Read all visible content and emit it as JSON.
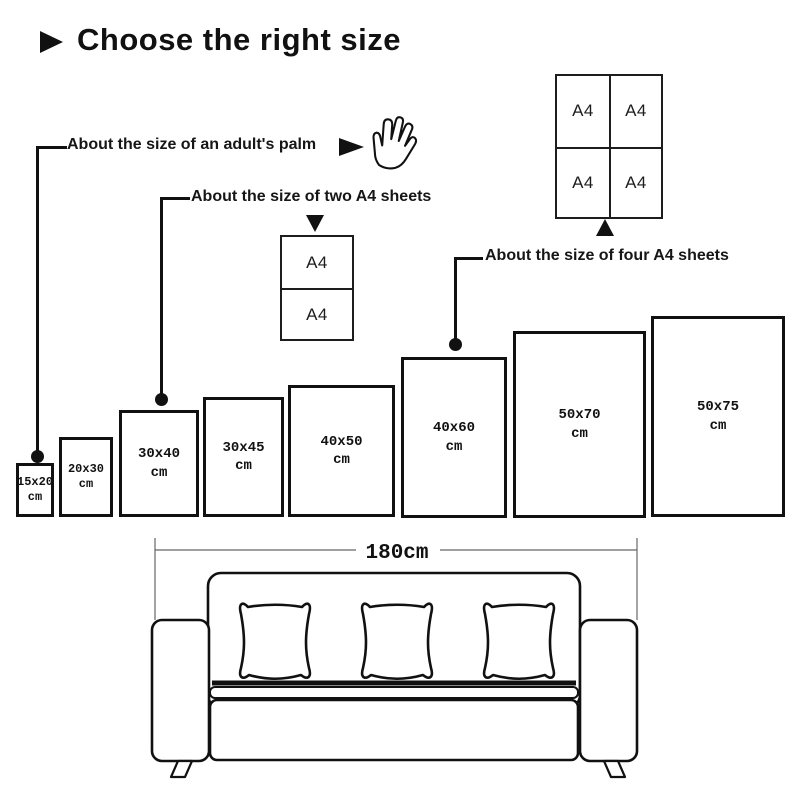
{
  "title": {
    "text": "Choose the right size"
  },
  "annotations": {
    "palm": "About the size of an adult's palm",
    "two_a4": "About the size of two A4 sheets",
    "four_a4": "About the size of four A4 sheets"
  },
  "a4_label": "A4",
  "frames": [
    {
      "size": "15x20",
      "unit": "cm"
    },
    {
      "size": "20x30",
      "unit": "cm"
    },
    {
      "size": "30x40",
      "unit": "cm"
    },
    {
      "size": "30x45",
      "unit": "cm"
    },
    {
      "size": "40x50",
      "unit": "cm"
    },
    {
      "size": "40x60",
      "unit": "cm"
    },
    {
      "size": "50x70",
      "unit": "cm"
    },
    {
      "size": "50x75",
      "unit": "cm"
    }
  ],
  "sofa": {
    "width_label": "180cm"
  },
  "colors": {
    "ink": "#111111",
    "line_gray": "#666666",
    "background": "#ffffff"
  }
}
